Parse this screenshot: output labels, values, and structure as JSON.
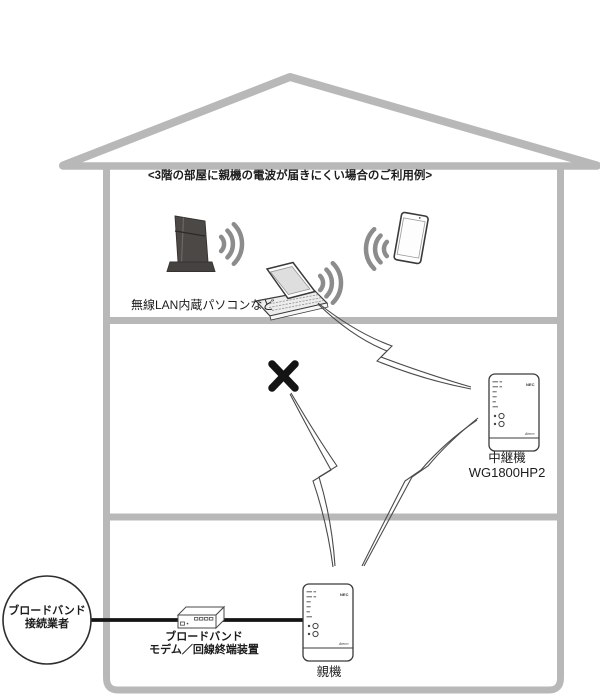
{
  "title": "<3階の部屋に親機の電波が届きにくい場合のご利用例>",
  "floor3": {
    "pc_label": "無線LAN内蔵パソコンなど"
  },
  "floor2": {
    "repeater": {
      "label": "中継機",
      "model": "WG1800HP2",
      "brand": "NEC",
      "series": "Aterm"
    }
  },
  "floor1": {
    "parent": {
      "label": "親機",
      "brand": "NEC",
      "series": "Aterm"
    },
    "provider": {
      "line1": "ブロードバンド",
      "line2": "接続業者"
    },
    "modem": {
      "line1": "ブロードバンド",
      "line2": "モデム／回線終端装置"
    }
  },
  "colors": {
    "house_gray": "#b8b8b8",
    "wave_gray": "#8c8c8c",
    "line_dark": "#4a4a4a",
    "cable_black": "#141414",
    "cross_black": "#141414"
  }
}
